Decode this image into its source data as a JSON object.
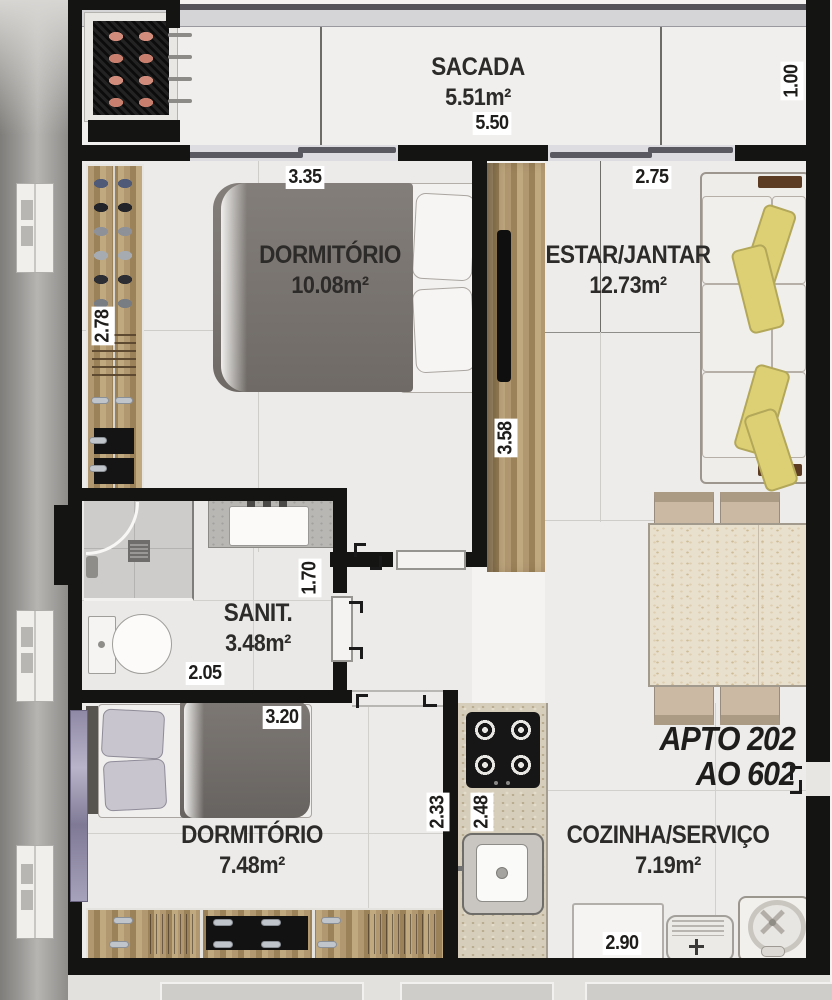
{
  "title": {
    "line1": "APTO 202",
    "line2": "AO 602"
  },
  "rooms": {
    "sacada": {
      "name": "SACADA",
      "area": "5.51m²"
    },
    "dormitorio1": {
      "name": "DORMITÓRIO",
      "area": "10.08m²"
    },
    "estar": {
      "name": "ESTAR/JANTAR",
      "area": "12.73m²"
    },
    "sanit": {
      "name": "SANIT.",
      "area": "3.48m²"
    },
    "dormitorio2": {
      "name": "DORMITÓRIO",
      "area": "7.48m²"
    },
    "cozinha": {
      "name": "COZINHA/SERVIÇO",
      "area": "7.19m²"
    }
  },
  "dimensions": {
    "sacada_width": "5.50",
    "sacada_depth": "1.00",
    "dorm1_width": "3.35",
    "estar_width": "2.75",
    "closet_depth": "2.78",
    "tv_wall_length": "3.58",
    "sanit_width": "2.05",
    "sanit_depth": "1.70",
    "dorm2_width": "3.20",
    "dorm2_depth": "2.33",
    "cozinha_depth": "2.48",
    "cozinha_width": "2.90"
  },
  "colors": {
    "wall": "#141413",
    "floor": "#ecebe9",
    "corridor": "#9b9996",
    "marble": "#e9dfcd",
    "counter": "#d6cdba",
    "cushion": "#ddd074",
    "duvet": "#76716d",
    "curtain": "#938daa",
    "text": "#2d2b29"
  }
}
